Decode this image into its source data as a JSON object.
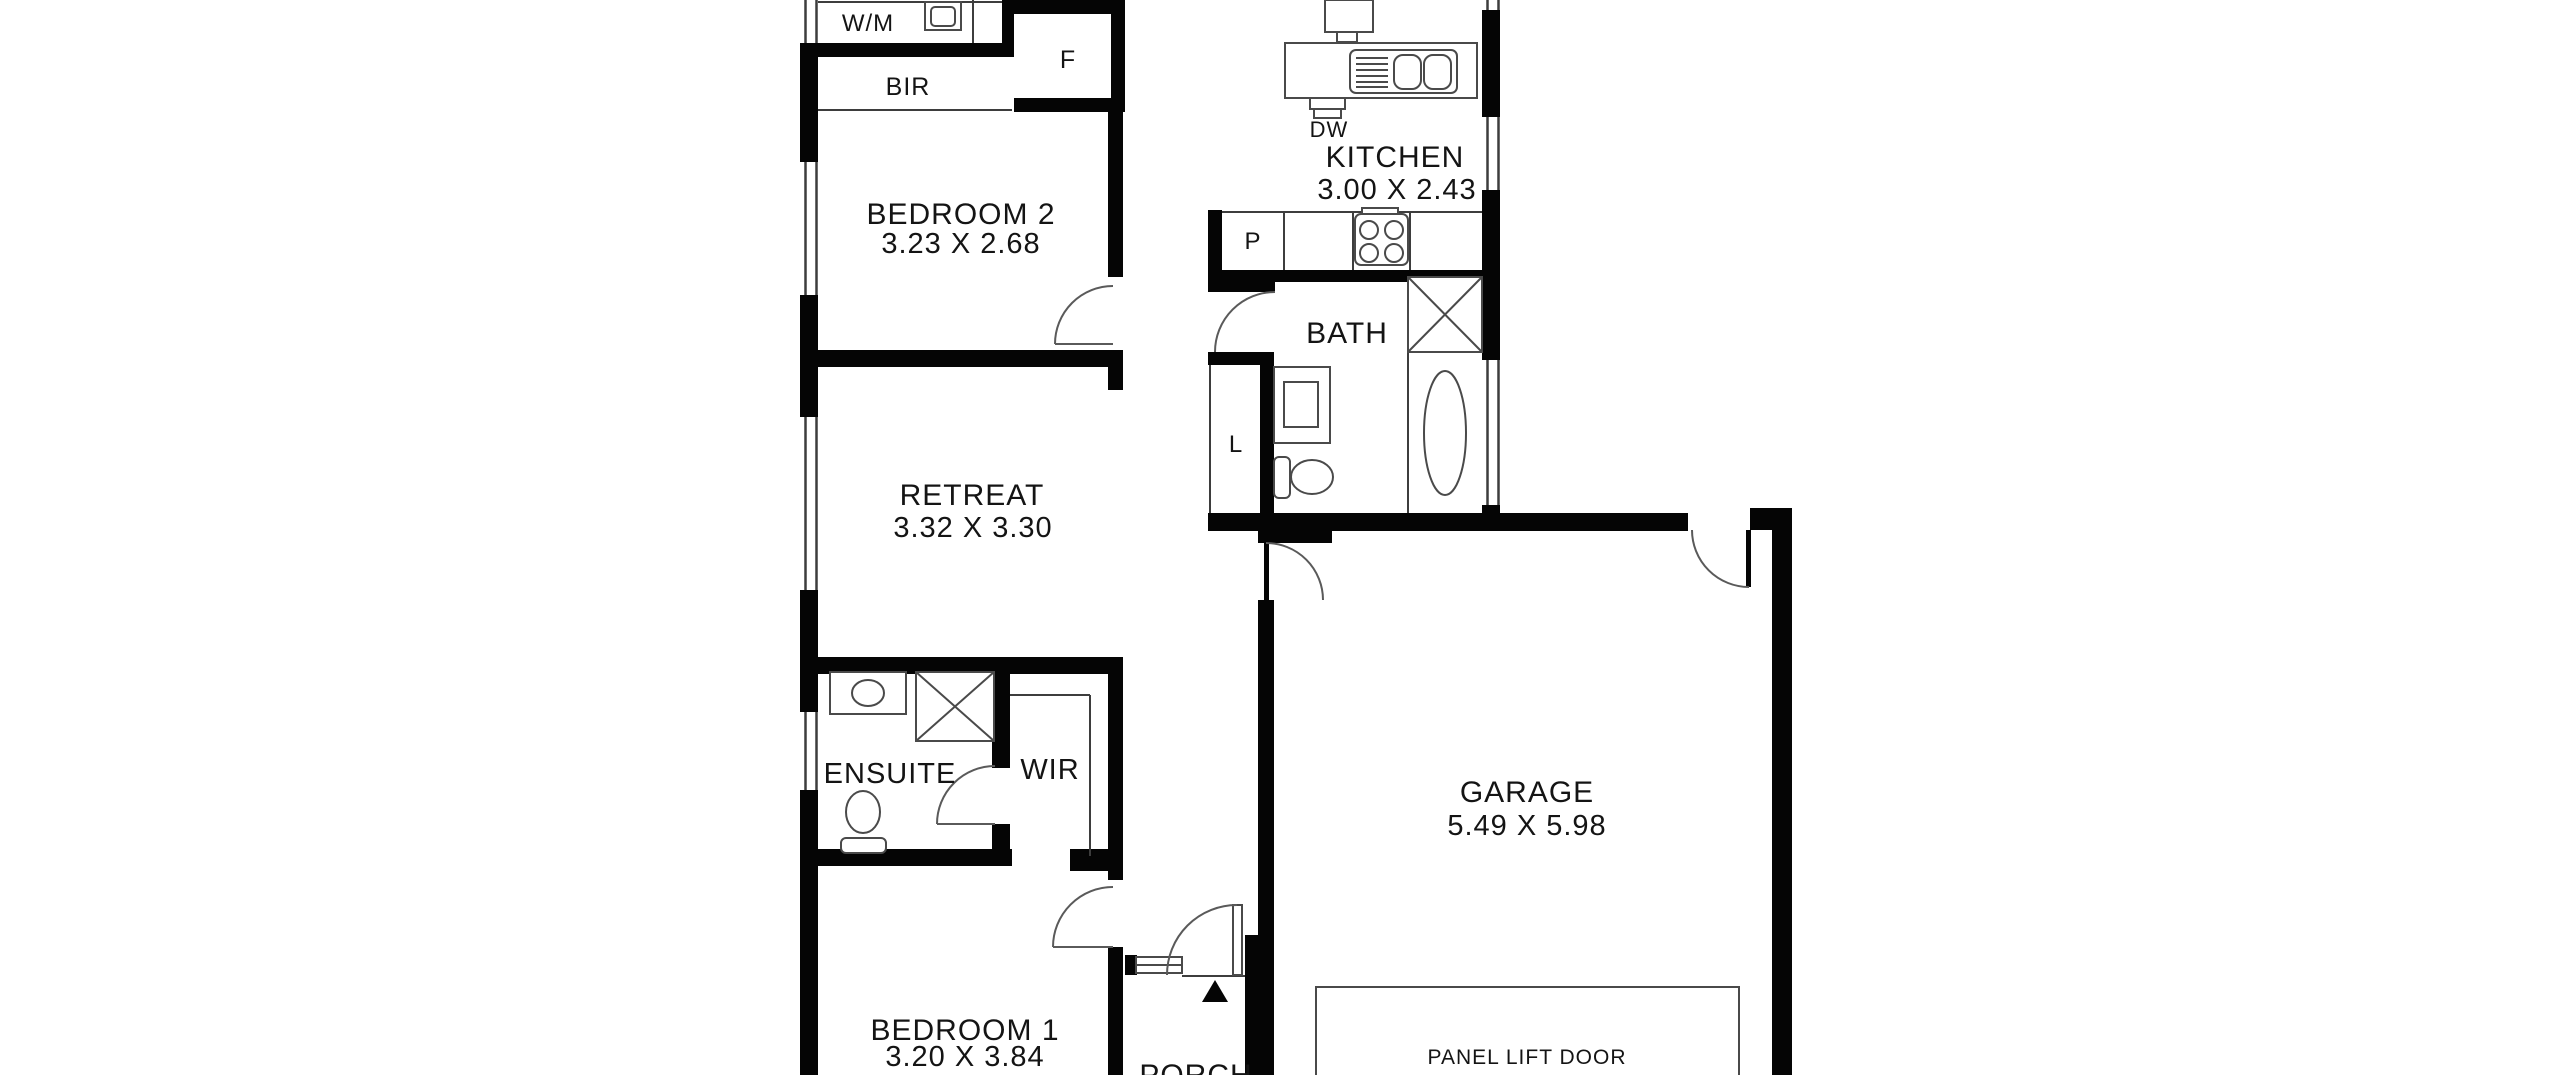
{
  "plan": {
    "colors": {
      "bg": "#ffffff",
      "wall": "#050505",
      "line": "#3d3d3d",
      "fixture": "#4a4a4a",
      "text": "#141414"
    },
    "rooms": {
      "bedroom2": {
        "name": "BEDROOM 2",
        "dims": "3.23 X 2.68"
      },
      "kitchen": {
        "name": "KITCHEN",
        "dims": "3.00 X 2.43"
      },
      "bath": {
        "name": "BATH"
      },
      "retreat": {
        "name": "RETREAT",
        "dims": "3.32 X 3.30"
      },
      "ensuite": {
        "name": "ENSUITE"
      },
      "wir": {
        "name": "WIR"
      },
      "garage": {
        "name": "GARAGE",
        "dims": "5.49 X 5.98"
      },
      "bedroom1": {
        "name": "BEDROOM 1",
        "dims": "3.20 X 3.84"
      },
      "porch": {
        "name": "PORCH"
      }
    },
    "fixture_labels": {
      "washing_machine": "W/M",
      "built_in_robe": "BIR",
      "fridge": "F",
      "dishwasher": "DW",
      "pantry": "P",
      "linen": "L",
      "panel_lift_door": "PANEL LIFT DOOR"
    }
  }
}
